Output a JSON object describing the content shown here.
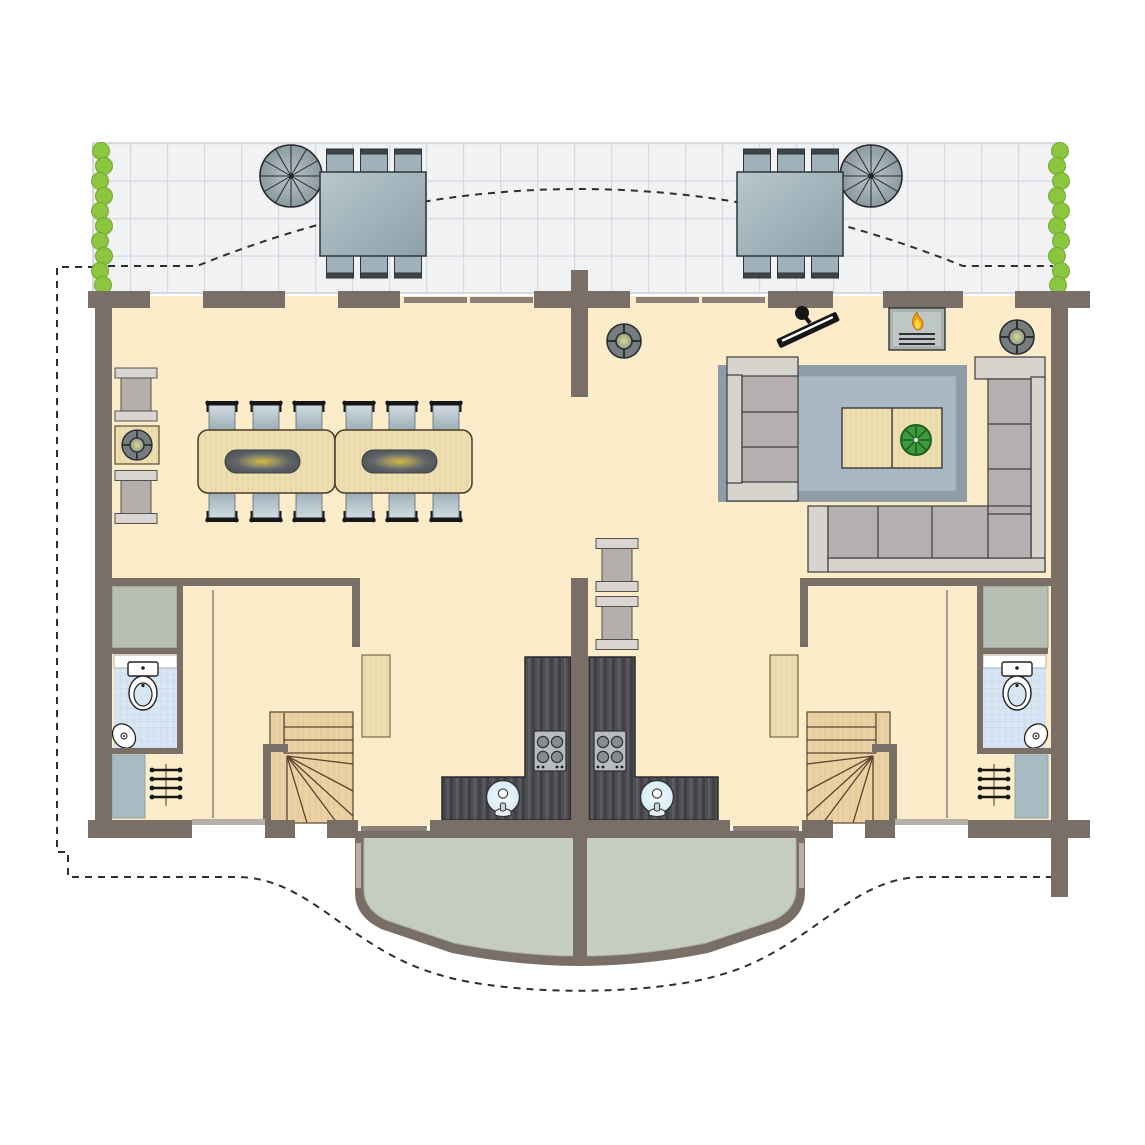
{
  "title": "duplex-holiday-home-floor-plan",
  "colors": {
    "wall": "#7a6f67",
    "floor": "#fcecca",
    "tile": "#f1f2f4",
    "tileline": "#d8d9de",
    "hedge": "#8cc63e",
    "hedgedark": "#74a932",
    "dash": "#2f2f2f",
    "outline": "#2f2f2f",
    "terrtable1": "#b7c7cd",
    "terrtable2": "#8da1aa",
    "terrchair": "#9fb2ba",
    "terrchaircap": "#3f4447",
    "spiral1": "#b9c4c8",
    "spiral2": "#8b9aa0",
    "wood": "#eedfb2",
    "woodgrain": "#dfcb97",
    "chair1": "#d3dde2",
    "chair2": "#9cafb8",
    "runnerglow": "#d7b83e",
    "runneredge": "#54585d",
    "flange": "#d9d6d1",
    "cabinetbody": "#b3b0ac",
    "sofa": "#b5afaf",
    "sofalight": "#d7d3cd",
    "rugborder": "#8d9ca7",
    "rugfield": "#a9b8c2",
    "plantdark": "#1e6223",
    "plantlight": "#3c9a3c",
    "firebody": "#a9b1b1",
    "flameorange": "#f59d00",
    "flameyellow": "#ffd54f",
    "fanring": "#757d7f",
    "fanglow": "#dcdc8d",
    "counter": "#4e4e53",
    "countergrain": "#3e3e43",
    "countergrain2": "#5e5e64",
    "stove": "#b9bdc0",
    "burner": "#898c8f",
    "sink": "#d8ecfa",
    "stairs": "#ebd2a4",
    "stairline": "#5a4330",
    "bay": "#c5ccc1",
    "bathtile": "#d8e5f2",
    "bathline": "#c4d6e8",
    "closetgreen": "#b7bfb4",
    "closetblue": "#a9bbc2",
    "windowline": "#b7b0a9",
    "sliderline": "#8b8178",
    "black": "#161616",
    "white": "#ffffff"
  },
  "floorplan": {
    "type": "mirrored-duplex-ground-floor",
    "units": [
      "left-apartment",
      "right-apartment"
    ],
    "terrace": {
      "outdoor_dining_tables": 2,
      "chairs_per_table": 6,
      "spiral_staircases": 2,
      "hedges": 2,
      "paving": "tiled-grid"
    },
    "left_apartment": {
      "rooms": [
        "dining-room",
        "kitchen",
        "entrance-hall",
        "bathroom"
      ],
      "furniture": [
        "dining-table",
        "dining-table",
        "dining-chair-x12",
        "sideboard",
        "sideboard",
        "side-table-with-fan",
        "kitchen-counter-l-shape",
        "hob-4-burner",
        "round-sink",
        "winder-staircase",
        "wardrobe-panel",
        "coat-rack",
        "toilet",
        "corner-washbasin",
        "closet",
        "closet"
      ]
    },
    "right_apartment": {
      "rooms": [
        "living-room",
        "kitchen",
        "entrance-hall",
        "bathroom"
      ],
      "furniture": [
        "three-seat-sofa",
        "corner-sofa",
        "area-rug",
        "coffee-table-two-part",
        "potted-plant",
        "fireplace",
        "wall-tv",
        "ceiling-fan",
        "ceiling-fan",
        "storage-cabinet",
        "storage-cabinet",
        "kitchen-counter-l-shape",
        "hob-4-burner",
        "round-sink",
        "winder-staircase",
        "wardrobe-panel",
        "coat-rack",
        "toilet",
        "corner-washbasin",
        "closet",
        "closet"
      ]
    },
    "shared": [
      "curved-bay-balcony-split-by-divider-wall",
      "dashed-roof-overhang-outline",
      "dashed-plot-boundary"
    ]
  },
  "icons": [
    "spiral-staircase-icon",
    "hedge-icon",
    "ceiling-fan-icon",
    "fireplace-flame-icon",
    "tv-icon",
    "plant-icon",
    "hob-icon",
    "sink-icon",
    "toilet-icon",
    "washbasin-icon",
    "coat-rack-icon",
    "stairs-icon",
    "sofa-icon",
    "dining-table-icon",
    "chair-icon"
  ]
}
